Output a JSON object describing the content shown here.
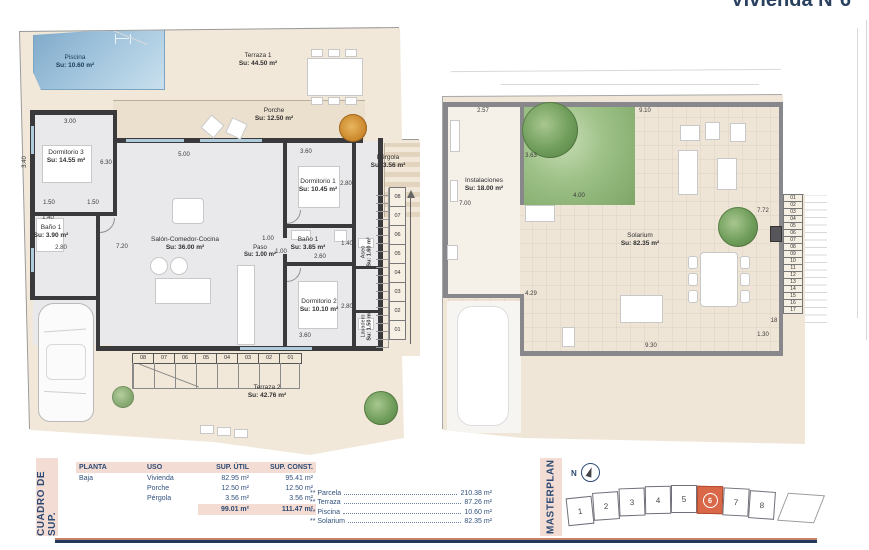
{
  "title": "Vivienda Nº6",
  "colors": {
    "navy": "#2d4a74",
    "salmon_accent": "#d96848",
    "pool_blue": "#8fb8d4",
    "garden_green": "#8fb87a",
    "parcel_beige": "#f2e8d9"
  },
  "plan1": {
    "labels": {
      "piscina": {
        "name": "Piscina",
        "area": "Su: 10.60 m²"
      },
      "terraza1": {
        "name": "Terraza 1",
        "area": "Su: 44.50 m²"
      },
      "porche": {
        "name": "Porche",
        "area": "Su: 12.50 m²"
      },
      "pergola": {
        "name": "Pérgola",
        "area": "Su: 3.56 m²"
      },
      "dormitorio3": {
        "name": "Dormitorio 3",
        "area": "Su: 14.55 m²"
      },
      "bano1_izq": {
        "name": "Baño 1",
        "area": "Su: 3.90 m²"
      },
      "salon": {
        "name": "Salón-Comedor-Cocina",
        "area": "Su: 36.00 m²"
      },
      "paso": {
        "name": "Paso",
        "area": "Su: 1.00 m²"
      },
      "bano1_der": {
        "name": "Baño 1",
        "area": "Su: 3.85 m²"
      },
      "dormitorio1": {
        "name": "Dormitorio 1",
        "area": "Su: 10.45 m²"
      },
      "dormitorio2": {
        "name": "Dormitorio 2",
        "area": "Su: 10.10 m²"
      },
      "aseo": {
        "name": "Aseo",
        "area": "Su: 1.60 m²"
      },
      "lavadero": {
        "name": "Lavadero",
        "area": "Su: 1.50 m²"
      },
      "terraza2": {
        "name": "Terraza 2",
        "area": "Su: 42.76 m²"
      }
    },
    "dims": [
      "3.00",
      "3.40",
      "6.30",
      "1.50",
      "1.50",
      "1.40",
      "2.80",
      "5.00",
      "7.20",
      "3.60",
      "2.80",
      "1.40",
      "2.60",
      "1.00",
      "1.00",
      "2.80",
      "3.60"
    ],
    "stairs_bottom": [
      "08",
      "07",
      "06",
      "05",
      "04",
      "03",
      "02",
      "01"
    ],
    "stairs_side": [
      "08",
      "07",
      "06",
      "05",
      "04",
      "03",
      "02",
      "01"
    ]
  },
  "plan2": {
    "labels": {
      "instalaciones": {
        "name": "Instalaciones",
        "area": "Su: 18.00 m²"
      },
      "solarium": {
        "name": "Solarium",
        "area": "Su: 82.35 m²"
      }
    },
    "dims": [
      "2.57",
      "9.10",
      "3.63",
      "7.00",
      "4.00",
      "4.29",
      "7.72",
      "9.30",
      "1.30",
      "18"
    ],
    "stairs": [
      "01",
      "02",
      "03",
      "04",
      "05",
      "06",
      "07",
      "08",
      "09",
      "10",
      "11",
      "12",
      "13",
      "14",
      "15",
      "16",
      "17"
    ]
  },
  "summary": {
    "side_label": "CUADRO DE SUP.",
    "headers": [
      "PLANTA",
      "USO",
      "SUP. ÚTIL",
      "SUP. CONST."
    ],
    "rows": [
      {
        "planta": "Baja",
        "uso": "Vivienda",
        "util": "82.95 m²",
        "const": "95.41 m²"
      },
      {
        "planta": "",
        "uso": "Porche",
        "util": "12.50 m²",
        "const": "12.50 m²"
      },
      {
        "planta": "",
        "uso": "Pérgola",
        "util": "3.56 m²",
        "const": "3.56 m²"
      }
    ],
    "total_util": "99.01 m²",
    "total_const": "111.47 m²",
    "extras": [
      {
        "name": "** Parcela",
        "value": "210.38 m²"
      },
      {
        "name": "** Terraza",
        "value": "87.26 m²"
      },
      {
        "name": "** Piscina",
        "value": "10.60 m²"
      },
      {
        "name": "** Solarium",
        "value": "82.35 m²"
      }
    ]
  },
  "masterplan": {
    "side_label": "MASTERPLAN",
    "north": "N",
    "units": [
      {
        "label": "1"
      },
      {
        "label": "2"
      },
      {
        "label": "3"
      },
      {
        "label": "4"
      },
      {
        "label": "5"
      },
      {
        "label": "6",
        "cls": "unit-hl"
      },
      {
        "label": "7"
      },
      {
        "label": "8"
      }
    ]
  }
}
